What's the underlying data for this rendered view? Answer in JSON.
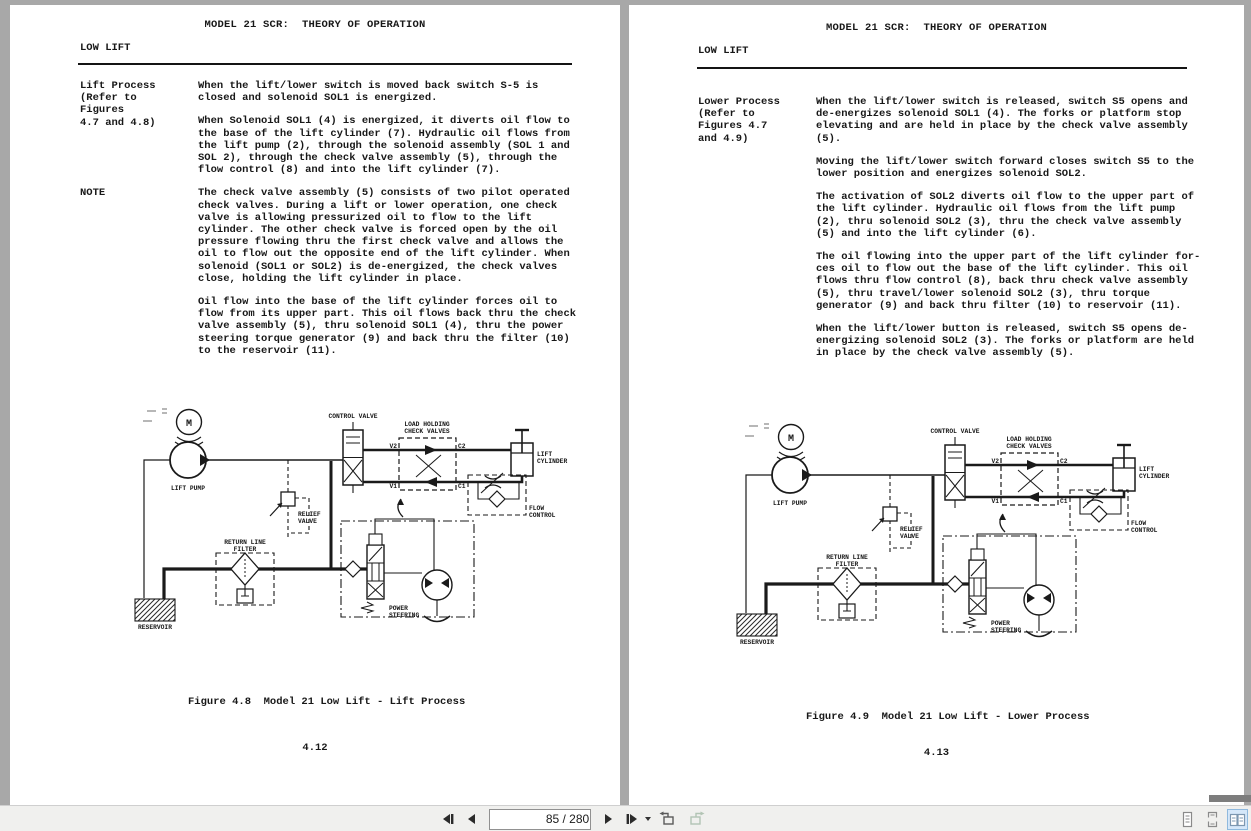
{
  "toolbar": {
    "page_indicator": "85 / 280"
  },
  "pages": {
    "left": {
      "header": "MODEL 21 SCR:  THEORY OF OPERATION",
      "section_title": "LOW LIFT",
      "blocks": [
        {
          "label": "Lift Process\n(Refer to\nFigures\n4.7 and 4.8)",
          "paras": [
            "When the lift/lower switch is moved back switch S-5 is\nclosed and solenoid SOL1 is energized.",
            "When Solenoid SOL1 (4) is energized, it diverts oil flow to\nthe base of the lift cylinder (7).  Hydraulic oil flows from\nthe lift pump (2), through the solenoid assembly (SOL 1 and\nSOL 2), through the check valve assembly (5), through the\nflow control (8) and into the lift cylinder (7)."
          ]
        },
        {
          "label": "NOTE",
          "paras": [
            "The check valve assembly (5) consists of two pilot operated\ncheck valves.  During a lift or lower operation, one check\nvalve is allowing pressurized oil to flow to the lift\ncylinder.  The other check valve is forced open by the oil\npressure flowing thru the first check valve and allows the\noil to flow out the opposite end of the lift cylinder.  When\nsolenoid (SOL1 or SOL2) is de-energized, the check valves\nclose, holding the lift cylinder in place.",
            "Oil flow into the base of the lift cylinder forces oil to\nflow from its upper part.  This oil flows back thru the check\nvalve assembly (5), thru solenoid SOL1 (4), thru the power\nsteering torque generator (9) and back thru the filter (10)\nto the reservoir (11)."
          ]
        }
      ],
      "figure_caption": "Figure 4.8  Model 21 Low Lift - Lift Process",
      "page_number": "4.12"
    },
    "right": {
      "header": "MODEL 21 SCR:  THEORY OF OPERATION",
      "section_title": "LOW LIFT",
      "blocks": [
        {
          "label": "Lower Process\n(Refer to\nFigures 4.7\nand 4.9)",
          "paras": [
            "When the lift/lower switch is released, switch S5 opens and\nde-energizes solenoid SOL1 (4).  The forks or platform stop\nelevating and are held in place by the check valve assembly\n(5).",
            "Moving the lift/lower switch forward closes switch S5 to the\nlower position and energizes solenoid SOL2.",
            "The activation of SOL2 diverts oil flow to the upper part of\nthe lift cylinder.  Hydraulic oil flows from the lift pump\n(2), thru solenoid SOL2 (3), thru the check valve assembly\n(5) and into the lift cylinder (6).",
            "The oil flowing into the upper part of the lift cylinder for-\nces oil to flow out the base of the lift cylinder.  This oil\nflows thru flow control (8), back thru check valve assembly\n(5), thru travel/lower solenoid SOL2  (3), thru torque\ngenerator (9) and back thru filter (10) to reservoir (11).",
            "When the lift/lower button is released, switch S5 opens de-\nenergizing solenoid SOL2 (3).  The forks or platform are held\nin place by the check valve assembly (5)."
          ]
        }
      ],
      "figure_caption": "Figure 4.9  Model 21 Low Lift - Lower Process",
      "page_number": "4.13"
    }
  },
  "diagram": {
    "labels": {
      "motor": "M",
      "lift_pump": "LIFT PUMP",
      "control_valve": "CONTROL VALVE",
      "load_holding_line1": "LOAD HOLDING",
      "load_holding_line2": "CHECK VALVES",
      "port_v2": "V2",
      "port_c2": "C2",
      "port_v1": "V1",
      "port_c1": "C1",
      "lift_cylinder_line1": "LIFT",
      "lift_cylinder_line2": "CYLINDER",
      "flow_control_line1": "FLOW",
      "flow_control_line2": "CONTROL",
      "relief_valve_line1": "RELIEF",
      "relief_valve_line2": "VALVE",
      "return_filter_line1": "RETURN LINE",
      "return_filter_line2": "FILTER",
      "reservoir": "RESERVOIR",
      "power_steering_line1": "POWER",
      "power_steering_line2": "STEERING"
    }
  }
}
